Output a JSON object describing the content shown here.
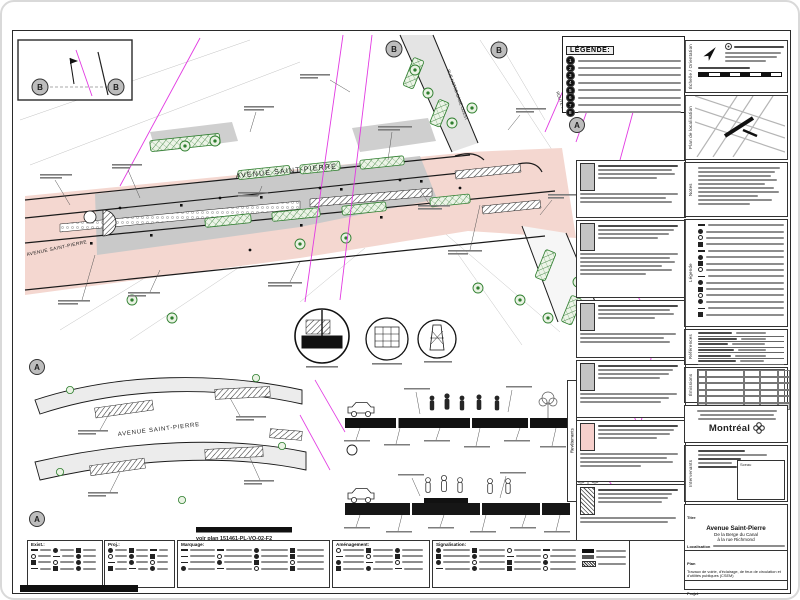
{
  "top_legend": {
    "title": "LÉGENDE:",
    "items": [
      "1",
      "2",
      "3",
      "4",
      "5",
      "6",
      "7",
      "8"
    ]
  },
  "plan": {
    "labels": {
      "avenue_main": "AVENUE SAINT-PIERRE",
      "avenue_left": "AVENUE SAINT-PIERRE",
      "rue_notre_dame": "RUE NOTRE-DAME OUEST",
      "route": "ROUTE 138"
    },
    "markers": {
      "a": "A",
      "b": "B"
    }
  },
  "inset": {
    "label": "AVENUE SAINT-PIERRE",
    "note": "voir plan 151461-PL-VO-02-F2",
    "marker": "A"
  },
  "sidebar": {
    "echelle_label": "Échelle / Orientation",
    "localisation_label": "Plan de localisation",
    "notes_label": "Notes",
    "legende_label": "Légende",
    "references_label": "Références",
    "emissions_label": "Émissions",
    "intervenants_label": "Intervenants",
    "sceau_label": "Sceau"
  },
  "notes_column": {
    "label": "Revêtements"
  },
  "bottom_legend": {
    "panels": [
      {
        "title": "Exist.:"
      },
      {
        "title": "Proj.:"
      },
      {
        "title": "Marquage:"
      },
      {
        "title": "Aménagement:"
      },
      {
        "title": "Signalisation:"
      }
    ]
  },
  "title_block": {
    "brand": "Montréal",
    "titre_label": "Titre",
    "title": "Avenue Saint-Pierre",
    "subtitle1": "De la Berge du Canal",
    "subtitle2": "à la rue Richmond",
    "localisation_label": "Localisation",
    "plan_label": "Plan",
    "plan_text": "Travaux de voirie, d'éclairage, de feux de circulation et d'utilités publiques (CSEM)",
    "projet_label": "Projet",
    "projet_text": "Réaménagement géométrique, construction de trottoirs, de fosses de plantations, de piste cyclable et d'autres aménagements de chaussée dans l'avenue Saint-Pierre.",
    "cells": [
      {
        "label": "No",
        "value": "151461"
      },
      {
        "label": "Feuillet",
        "value": "PL-VO-03"
      },
      {
        "label": "Échelle",
        "value": "1:2"
      },
      {
        "label": "Émission",
        "value": "R03"
      },
      {
        "label": "Feuille",
        "value": "01"
      }
    ]
  },
  "colors": {
    "road_pink": "#f4d7d0",
    "pavement_gray": "#c9c9c9",
    "utility_magenta": "#e23ae2",
    "planting_green": "#2f7f2f"
  }
}
